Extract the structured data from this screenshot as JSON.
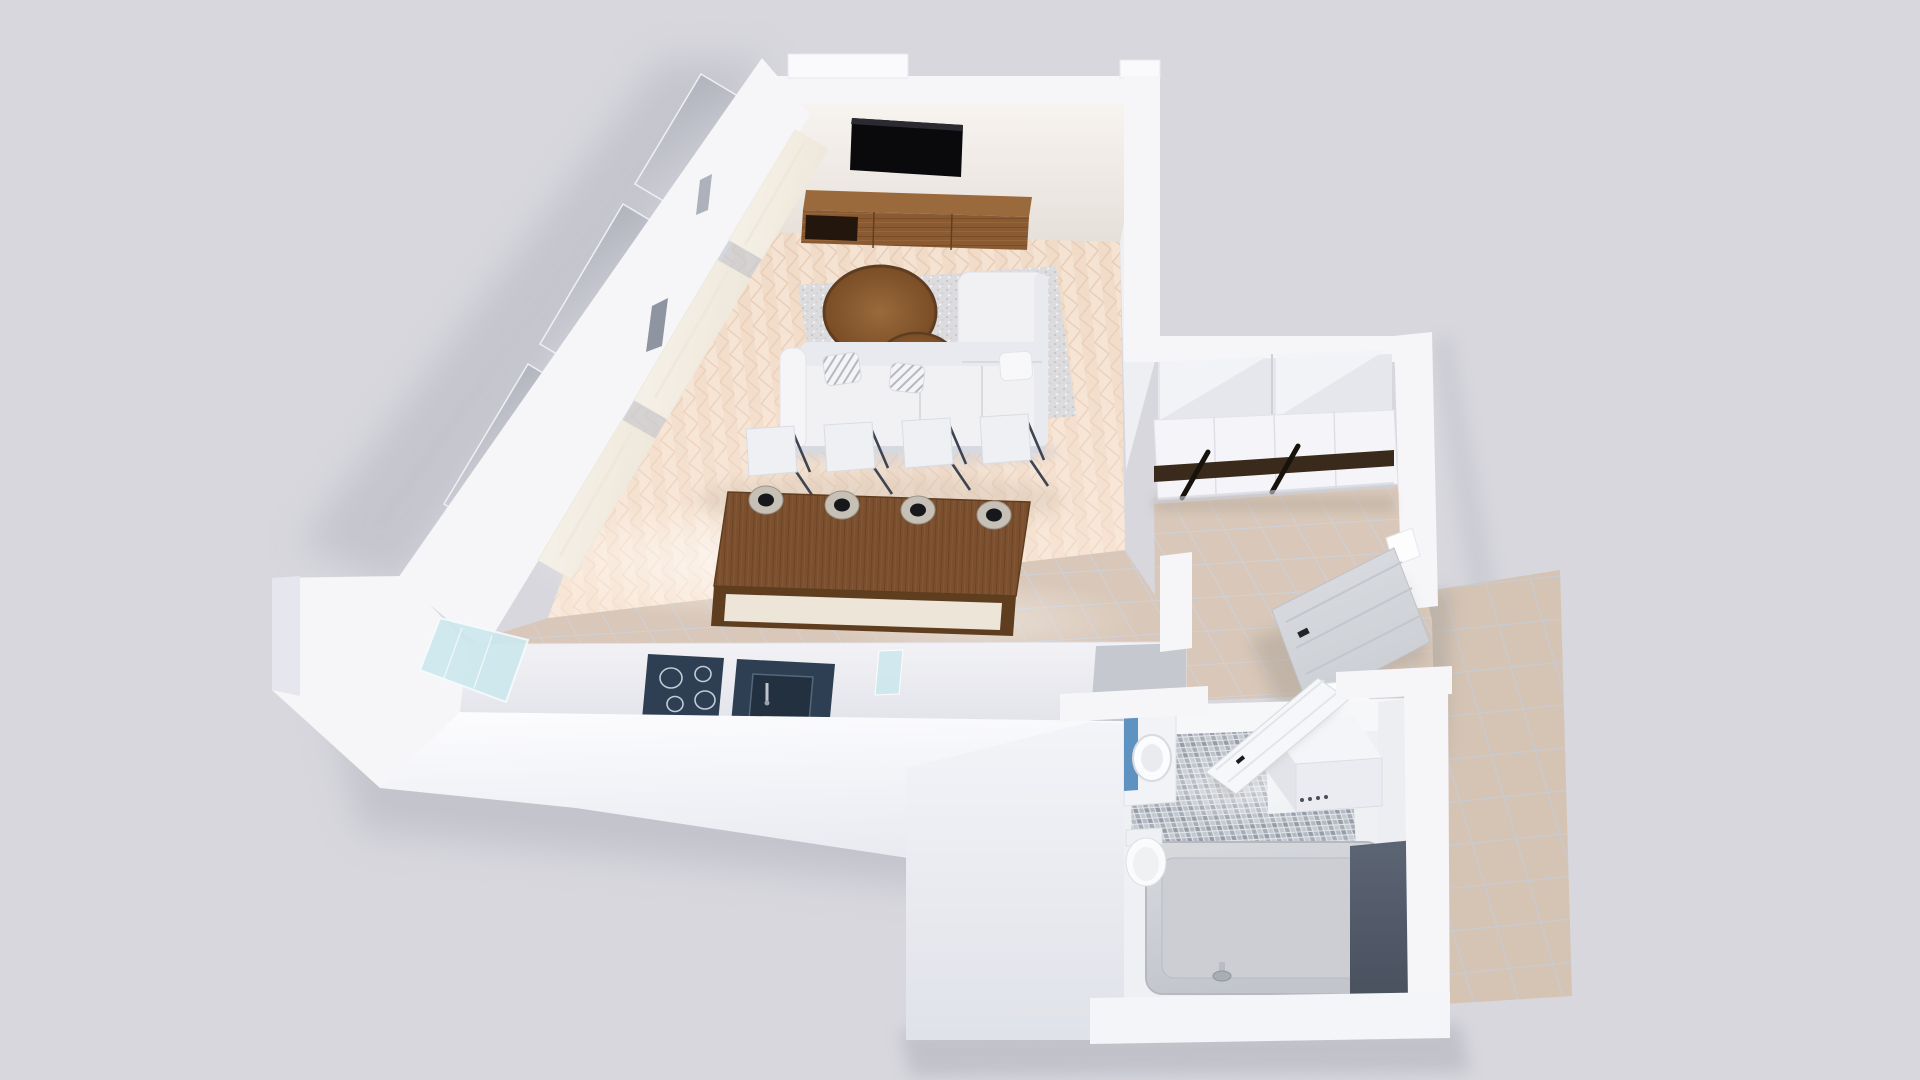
{
  "scene": {
    "type": "3d-floorplan-render",
    "view": "aerial-perspective-dollhouse",
    "rooms": [
      {
        "name": "living-room",
        "floor": "herringbone-wood"
      },
      {
        "name": "kitchen",
        "floor": "beige-tile"
      },
      {
        "name": "hallway",
        "floor": "beige-tile"
      },
      {
        "name": "bathroom",
        "floor": "gray-mosaic-tile"
      },
      {
        "name": "terrace",
        "floor": "large-beige-tile"
      }
    ],
    "furniture": [
      "wall-mounted-tv",
      "media-console",
      "corner-sofa",
      "area-rug",
      "nesting-coffee-table-large",
      "nesting-coffee-table-small",
      "dining-island",
      "dining-chair",
      "pendant-lamp",
      "cooktop",
      "kitchen-sink",
      "kitchen-counter",
      "glass-cabinet",
      "sliding-wardrobe",
      "front-door",
      "bathroom-door",
      "toilet",
      "washbasin",
      "washing-machine",
      "bathtub",
      "window-glazing",
      "curtain"
    ],
    "counts": {
      "dining_chairs": 4,
      "pendant_lamps": 4,
      "cooktop_burners": 4,
      "curtain_panels": 3,
      "window_glass_slabs": 3,
      "sofa_pillows": 3
    },
    "materials": {
      "living_floor": "light herringbone parquet",
      "wet_floor": "beige ceramic tile",
      "bath_floor": "gray mosaic",
      "tub_surround": "dark blue-gray marble",
      "island_top": "dark walnut wood"
    }
  },
  "colors": {
    "background": "#d7d7dd",
    "shadow": "#b3b3bf",
    "wall_top": "#f6f6f9",
    "wall_bright": "#fdfdff",
    "wall_face": "#edeff3",
    "wall_shade": "#e0e2e9",
    "backwall_light": "#f7f3ef",
    "backwall_dark": "#e6e0da",
    "wood_floor_a": "#f4e3d3",
    "wood_floor_b": "#eccfb7",
    "wood_seam": "#e6cab2",
    "tile_floor": "#d9c8b9",
    "tile_line": "#ccd2dd",
    "terrace_tile": "#d5c4b4",
    "mosaic_bg": "#e3e5e9",
    "mosaic_a": "#c4c9d0",
    "mosaic_b": "#a7adb7",
    "mosaic_c": "#969ca7",
    "mosaic_d": "#b4bac3",
    "furniture_wood": "#8a5a33",
    "furniture_wood_dark": "#5f3d1f",
    "island_wood": "#7b5030",
    "island_panel": "#ece5d8",
    "sofa_white": "#f1f1f4",
    "sofa_shade": "#e9eaef",
    "rug": "#dcdcdf",
    "rug_dot": "#c2c2c7",
    "tv_black": "#0a0a0d",
    "navy": "#2e3f53",
    "navy_dark": "#22303f",
    "glass_blue": "#cde8ee",
    "glass_gray": "#8a909c",
    "curtain": "#f8f4ec",
    "curtain_shade": "#eee7da",
    "metal_dark": "#3e4550",
    "lamp_shade": "#c6c0b7",
    "lamp_top": "#17181c",
    "wardrobe_stripe": "#3a2a1b",
    "towel_blue": "#5e92c1",
    "marble_dark": "#5c6574",
    "marble_darker": "#49505e",
    "tub_light": "#d2d4d9",
    "door_gray": "#d7d9dd",
    "chrome": "#c0c5cc"
  }
}
